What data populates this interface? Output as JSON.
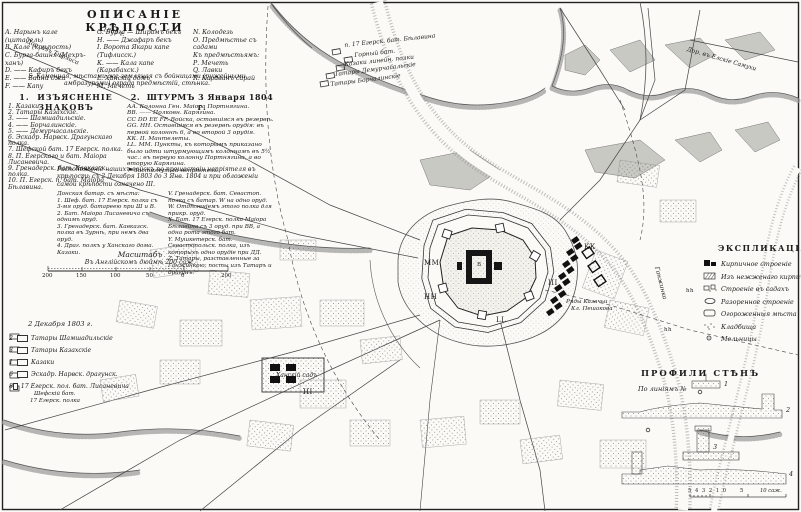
{
  "description": {
    "title": "ОПИСАНІЕ КРѢПОСТИ",
    "col1": [
      "А. Нарынъ кале (цитадель)",
      "В. Кале (крѣпость)",
      "С. Бурга-башня (Мехръ-ханъ)",
      "D. —— Кафиръ бекъ",
      "Е. —— Байни джа",
      "F. —— Капу"
    ],
    "col2": [
      "G. Бурга — Ширамъ бекъ",
      "Н. —— Джафаръ бекъ",
      "I. Ворота Якари капе (Тифлисск.)",
      "К. —— Кала капе (Карабахск.)",
      "L. Ханскій домъ",
      "М. Мечеть"
    ],
    "col3": [
      "N. Колодезь",
      "О. Предмѣстье съ садами",
      "Къ предмѣстьямъ:",
      "Р. Мечеть",
      "Q. Лавки",
      "R. Караванъ сарай"
    ],
    "note": "S. Каменная, мѣстами же земляная съ бойницами (ружейными амбразурами) ограда предмѣстій, стѣнка."
  },
  "signs": {
    "num": "1.",
    "title": "ИЗЪЯСНЕНІЕ ЗНАКОВЪ",
    "items": [
      "1. Казаки.",
      "2. Татары Казахскіе.",
      "3. —— Шамшадильскіе.",
      "4. —— Борчалинскіе.",
      "5. —— Демурчасальскіе.",
      "6. Эскадр. Нарвск. Драгунскаго полка.",
      "7. Шефской бат. 17 Егерск. полка.",
      "8. П. Егерскаго и бат. Маіора Лисаневича.",
      "9. Гренадерск. бат. Кавказск. полка.",
      "10. П. Егерск. п. бат. Маіора Бѣлавина."
    ]
  },
  "assault": {
    "num": "2.",
    "title": "ШТУРМЪ 3 Января 1804 г.",
    "items": [
      "АА. Колонна Ген. Маіора Портнягина.",
      "ВВ. —— Полковн. Карягина.",
      "СС DD ЕЕ FF. Войска, оставшіяся въ резервѣ.",
      "GG. НН. Оставшіяся въ резервѣ орудія: въ первой колоннѣ 6, а во второй 3 орудія.",
      "КК. II. Мантелеты.",
      "LL. ММ. Пункты, къ которымъ приказано было идти штурмующимъ колоннамъ въ 5½ час.: въ первую колонну Портнягина, а во вторую Карягина.",
      "⚑ Застигнутый непріятель."
    ]
  },
  "note2": "Расположеніе нашихъ войскъ по прошествіи непріятеля въ крѣпость съ 2 Декабря 1803 до 3 Янв. 1804 и при обложеніи самой крѣпости означено III.",
  "positions": {
    "left": [
      "Донская батар. съ мѣста:",
      "1. Шеф. бат. 17 Егерск. полка съ 3-мя оруд. батареею при Ш и В.",
      "2. Бат. Маіора Лисаневича съ однимъ оруд.",
      "3. Гренадерск. бат. Кавказск. полка въ Зурнѣ, при немъ два оруд.",
      "4. Драг. полкъ у Ханскаго дома.",
      "Казаки."
    ],
    "right": [
      "V. Гренадерск. бат. Севастоп. полка съ батар. W на одно оруд.",
      "W. Отдѣленіемъ этого полка для прикр. оруд.",
      "X. Бат. 17 Егерск. полка Маіора Бѣлавина съ 3 оруд. при ВВ, а одна рота этого бат.",
      "Y. Мушкетерск. бат. Севастопольск. полка, изъ которыхъ одно орудіе при ДД.",
      "Z. Татары, разставленные за Ганжинкою; посты изъ Татаръ и драгунъ."
    ]
  },
  "scale": {
    "title": "Масштабъ",
    "subtitle": "Въ Англійскомъ дюймѣ 200 саж.",
    "ticks": [
      "200",
      "150",
      "100",
      "50",
      "0",
      "200"
    ]
  },
  "december": {
    "heading": "2 Декабря 1803 г.",
    "items": [
      {
        "num": "2",
        "label": "Татары Шамшадильскіе"
      },
      {
        "num": "3",
        "label": "Татары Казахскіе"
      },
      {
        "num": "1",
        "label": "Казаки"
      },
      {
        "num": "6",
        "label": "Эскадр. Нарвск. драгунск."
      },
      {
        "num": "8",
        "label": "17 Егерск. пол. бат. Лисаневича"
      }
    ]
  },
  "explication": {
    "heading": "ЭКСПЛИКАЦІЯ",
    "items": [
      "Кирпичное строеніе",
      "Изъ нежженаго кирпича",
      "Строеніе въ садахъ",
      "Разоренное строеніе",
      "Огороженныя мѣста",
      "Кладбища",
      "Мельницы"
    ]
  },
  "profiles": {
    "heading": "ПРОФИЛИ СТѢНЪ",
    "sub": "По линіямъ №",
    "numbers": [
      "1",
      "2",
      "3",
      "4"
    ],
    "scale_ticks": "5 4 3 2 1 0",
    "scale_mid": "5",
    "scale_label": "10 саж."
  },
  "map": {
    "labels": [
      "Дор. изъ Тифлиса",
      "1803 г.",
      "п. 17 Егерск. бат. Бѣлавина",
      "Горный бат.",
      "Казаки линейн. полки",
      "Татары Демурчасальскіе",
      "Татары Борчалинскіе",
      "Ганжинка",
      "Ряды Казачьи",
      "Кл. Пешакова",
      "Ханскій садъ",
      "Шефскій бат.",
      "17 Егерск. полка",
      "Дор. въ Елскіе Самухи",
      "ММ",
      "НН",
      "LL",
      "III",
      "III",
      "КК",
      "В",
      "hh",
      "hh"
    ]
  }
}
